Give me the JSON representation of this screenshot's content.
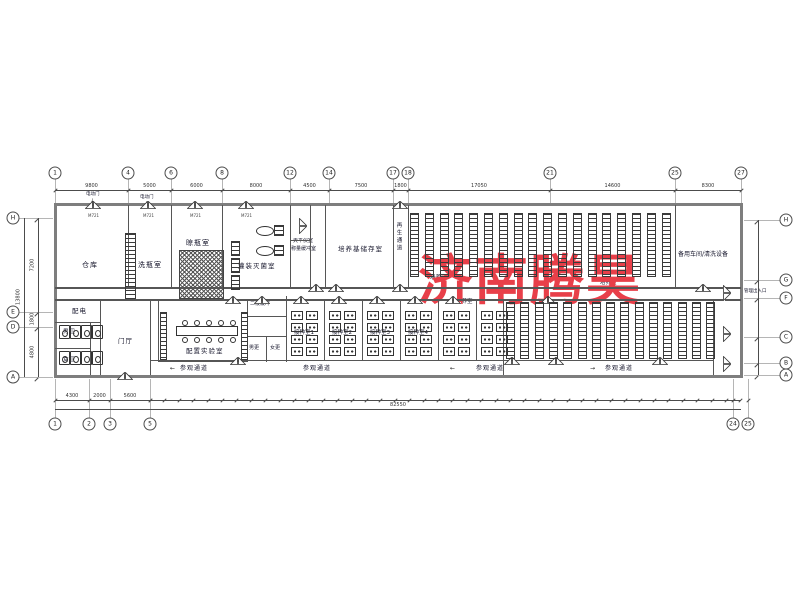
{
  "watermark": {
    "text": "济南腾昊",
    "color": "#E83F49"
  },
  "rooms": {
    "warehouse": "仓库",
    "bottle_washing": "洗瓶室",
    "bottle_drying": "晾瓶室",
    "filling_sterilization": "灌装灭菌室",
    "balance_room": "天平仪室",
    "weighing_buffer": "称量缓冲室",
    "medium_storage": "培养基储存室",
    "regen_corridor": "再生通道",
    "cultivation_room": "培养室",
    "spare_workshop": "备用车间/清洗设备",
    "power_distribution": "配电",
    "mens_toilet": "男卫",
    "womens_toilet": "女卫",
    "foyer": "门厅",
    "prep_lab": "配置实验室",
    "secondary_buffer": "二级缓冲",
    "mens_changing": "男更",
    "womens_changing": "女更",
    "inoculation_rooms": [
      "接种室1",
      "接种室2",
      "接种室3",
      "接种室4"
    ]
  },
  "annotations": {
    "visitor_corridor": "参观通道",
    "management_entrance": "管理出入口",
    "electric_door": "电动门",
    "door_code": "M721"
  },
  "arrows": {
    "left": "←",
    "right": "→",
    "down": "↓"
  },
  "grid": {
    "top_bubbles": [
      "1",
      "4",
      "6",
      "8",
      "12",
      "14",
      "17",
      "18",
      "21",
      "25",
      "27"
    ],
    "bottom_bubbles": [
      "1",
      "2",
      "3",
      "5",
      "24",
      "25"
    ],
    "left_bubbles": [
      "H",
      "E",
      "D",
      "A"
    ],
    "right_bubbles": [
      "H",
      "G",
      "F",
      "C",
      "B",
      "A"
    ]
  },
  "dimensions": {
    "top_segments": [
      "9800",
      "5000",
      "6000",
      "8000",
      "4500",
      "7500",
      "1800",
      "17050",
      "14600",
      "8300"
    ],
    "bottom_left_segments": [
      "4300",
      "2000",
      "5600"
    ],
    "overall_width": "82550",
    "left_segments": [
      "7200",
      "1800",
      "4800"
    ],
    "left_overall": "13800"
  }
}
